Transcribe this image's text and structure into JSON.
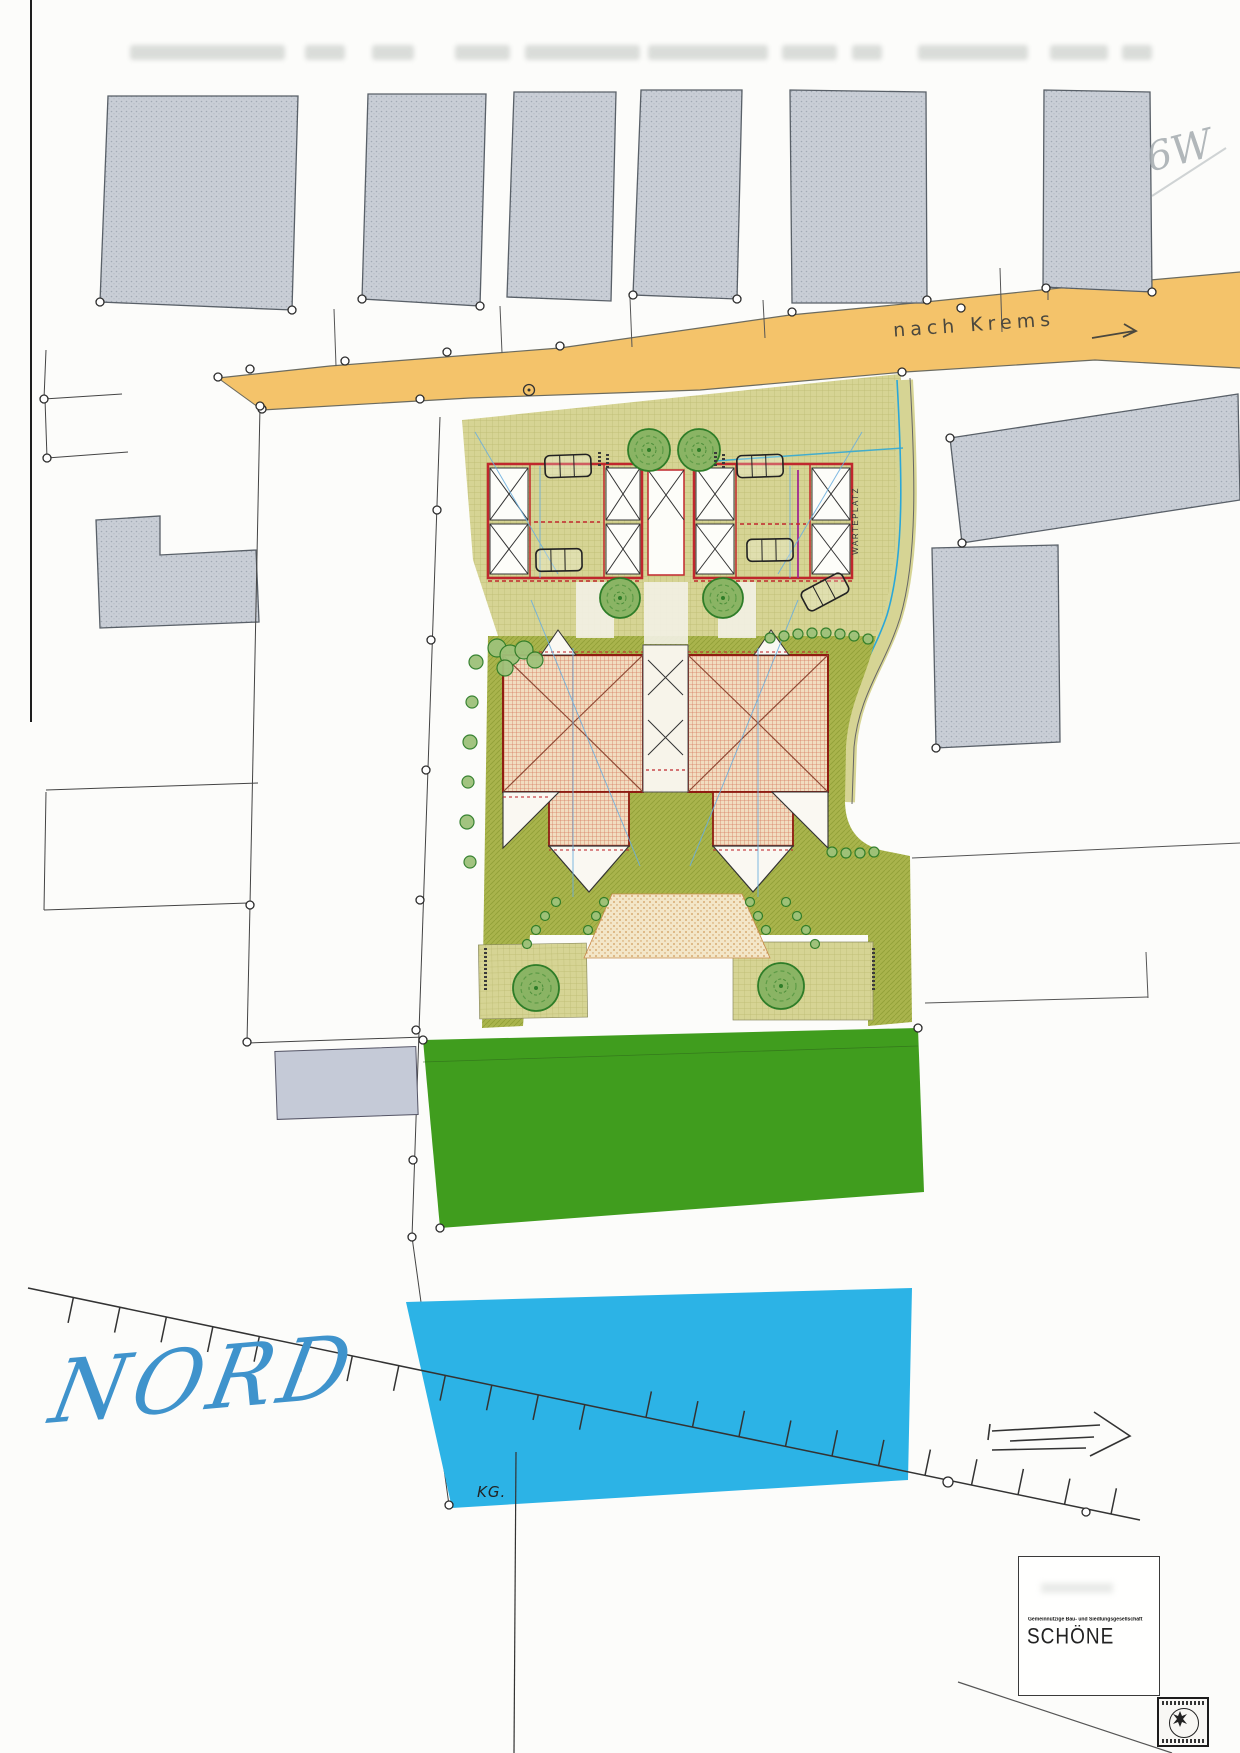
{
  "plan": {
    "road_label": "nach Krems",
    "north_label": "NORD",
    "cadastral_label": "KG.",
    "waiting_area_label": "WARTEPLATZ",
    "handwritten_note": "6W"
  },
  "title_block": {
    "company_line": "Gemeinnützige Bau- und Siedlungsgesellschaft",
    "company_name": "SCHÖNE"
  },
  "colors": {
    "road_orange": "#f4c36a",
    "lawn_green": "#47a524",
    "water_cyan": "#2cb3e6",
    "landscape_olive": "#a9b44c",
    "pavement_khaki": "#d6d494",
    "roof_red": "#cb5b40",
    "outline_dark_red": "#8f1d12",
    "garage_red": "#c0272d",
    "north_blue": "#3f93cc",
    "existing_gray": "#c9ced6"
  }
}
